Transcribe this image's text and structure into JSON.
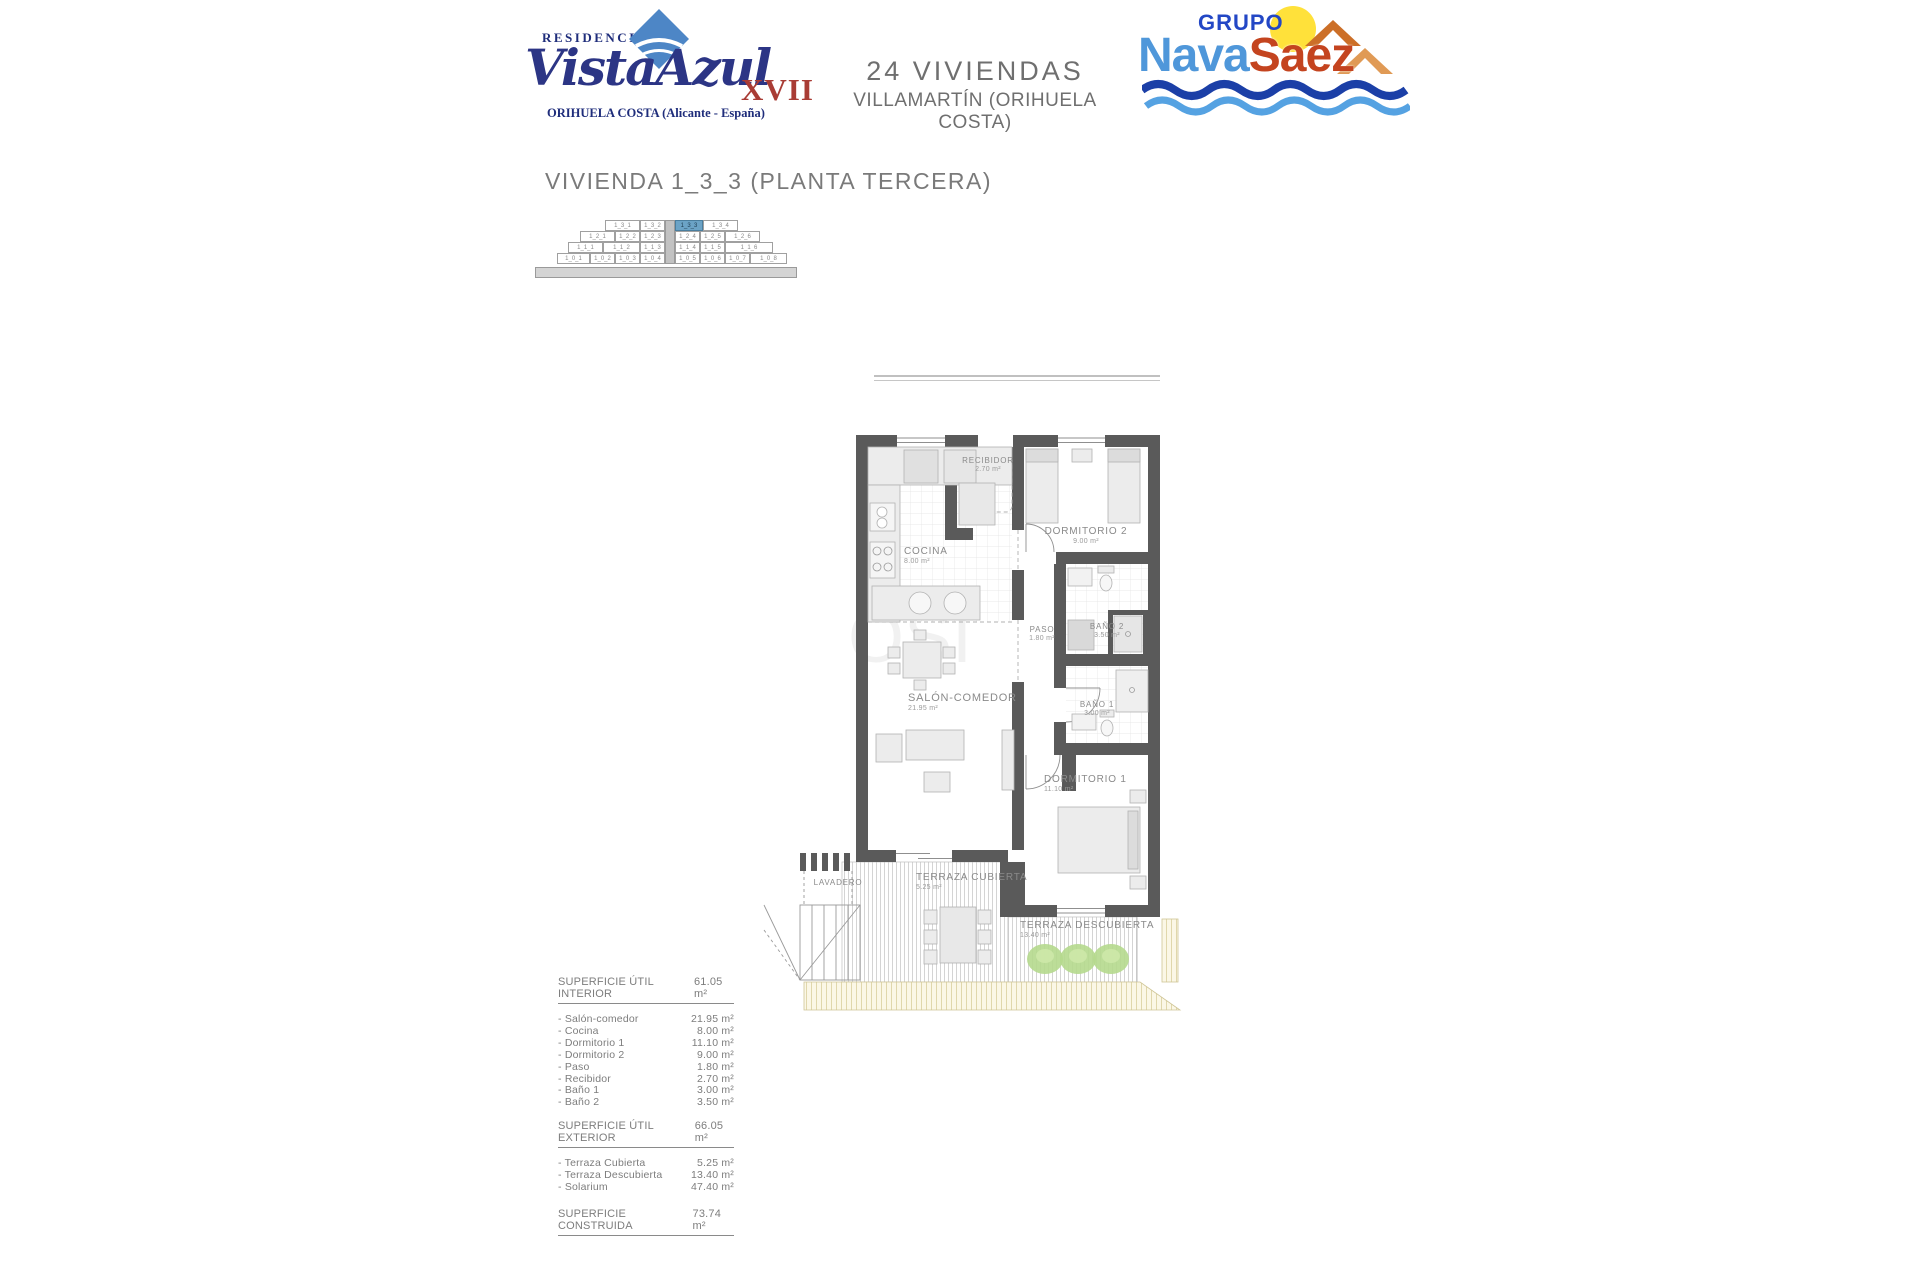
{
  "header": {
    "logo_vistaazul": {
      "residencial": "RESIDENCIAL",
      "name_script": "VistaAzul",
      "name_suffix": "XVII",
      "location": "ORIHUELA COSTA (Alicante - España)"
    },
    "project": {
      "line1": "24 VIVIENDAS",
      "line2": "VILLAMARTÍN (ORIHUELA COSTA)"
    },
    "logo_navasaez": {
      "grupo": "GRUPO",
      "nava": "Nava",
      "saez": "Saez"
    }
  },
  "page_title": "VIVIENDA 1_3_3 (PLANTA TERCERA)",
  "watermark": "OSI",
  "building_key": {
    "highlight": "1_3_3",
    "row_height": 11,
    "rows": [
      [
        {
          "x": 72,
          "w": 35,
          "t": "1_3_1"
        },
        {
          "x": 107,
          "w": 25,
          "t": "1_3_2"
        },
        {
          "x": 142,
          "w": 28,
          "t": "1_3_3"
        },
        {
          "x": 170,
          "w": 35,
          "t": "1_3_4"
        }
      ],
      [
        {
          "x": 47,
          "w": 35,
          "t": "1_2_1"
        },
        {
          "x": 82,
          "w": 25,
          "t": "1_2_2"
        },
        {
          "x": 107,
          "w": 25,
          "t": "1_2_3"
        },
        {
          "x": 142,
          "w": 25,
          "t": "1_2_4"
        },
        {
          "x": 167,
          "w": 25,
          "t": "1_2_5"
        },
        {
          "x": 192,
          "w": 35,
          "t": "1_2_6"
        }
      ],
      [
        {
          "x": 35,
          "w": 35,
          "t": "1_1_1"
        },
        {
          "x": 70,
          "w": 37,
          "t": "1_1_2"
        },
        {
          "x": 107,
          "w": 25,
          "t": "1_1_3"
        },
        {
          "x": 142,
          "w": 25,
          "t": "1_1_4"
        },
        {
          "x": 167,
          "w": 25,
          "t": "1_1_5"
        },
        {
          "x": 192,
          "w": 48,
          "t": "1_1_6"
        }
      ],
      [
        {
          "x": 24,
          "w": 33,
          "t": "1_0_1"
        },
        {
          "x": 57,
          "w": 25,
          "t": "1_0_2"
        },
        {
          "x": 82,
          "w": 25,
          "t": "1_0_3"
        },
        {
          "x": 107,
          "w": 25,
          "t": "1_0_4"
        },
        {
          "x": 142,
          "w": 25,
          "t": "1_0_5"
        },
        {
          "x": 167,
          "w": 25,
          "t": "1_0_6"
        },
        {
          "x": 192,
          "w": 25,
          "t": "1_0_7"
        },
        {
          "x": 217,
          "w": 37,
          "t": "1_0_8"
        }
      ]
    ]
  },
  "floorplan": {
    "rooms": {
      "recibidor": {
        "label": "RECIBIDOR",
        "area": "2.70 m²"
      },
      "cocina": {
        "label": "COCINA",
        "area": "8.00 m²"
      },
      "dormitorio2": {
        "label": "DORMITORIO 2",
        "area": "9.00 m²"
      },
      "paso": {
        "label": "PASO",
        "area": "1.80 m²"
      },
      "bano2": {
        "label": "BAÑO 2",
        "area": "3.50 m²"
      },
      "bano1": {
        "label": "BAÑO 1",
        "area": "3.00 m²"
      },
      "salon": {
        "label": "SALÓN-COMEDOR",
        "area": "21.95 m²"
      },
      "dormitorio1": {
        "label": "DORMITORIO 1",
        "area": "11.10 m²"
      },
      "lavadero": {
        "label": "LAVADERO",
        "area": ""
      },
      "terraza_cubierta": {
        "label": "TERRAZA CUBIERTA",
        "area": "5.25 m²"
      },
      "terraza_descubierta": {
        "label": "TERRAZA DESCUBIERTA",
        "area": "13.40 m²"
      }
    }
  },
  "surface_tables": [
    {
      "title": "SUPERFICIE ÚTIL INTERIOR",
      "total": "61.05 m²",
      "rows": [
        [
          "- Salón-comedor",
          "21.95 m²"
        ],
        [
          "- Cocina",
          "8.00 m²"
        ],
        [
          "- Dormitorio 1",
          "11.10 m²"
        ],
        [
          "- Dormitorio 2",
          "9.00 m²"
        ],
        [
          "- Paso",
          "1.80 m²"
        ],
        [
          "- Recibidor",
          "2.70 m²"
        ],
        [
          "- Baño 1",
          "3.00 m²"
        ],
        [
          "- Baño 2",
          "3.50 m²"
        ]
      ]
    },
    {
      "title": "SUPERFICIE ÚTIL EXTERIOR",
      "total": "66.05 m²",
      "rows": [
        [
          "- Terraza Cubierta",
          "5.25 m²"
        ],
        [
          "- Terraza Descubierta",
          "13.40 m²"
        ],
        [
          "- Solarium",
          "47.40 m²"
        ]
      ]
    },
    {
      "title": "SUPERFICIE CONSTRUIDA",
      "total": "73.74 m²",
      "rows": []
    }
  ],
  "colors": {
    "wall": "#5a5a5a",
    "accent_highlight": "#6ba3c6",
    "logo_navy": "#2c3585",
    "logo_red": "#a93c35",
    "nava_blue": "#4f97da",
    "saez_red": "#c4441f",
    "sun_yellow": "#ffe13a",
    "plant_green": "#b5d98d",
    "text_gray": "#7a7a7a"
  }
}
